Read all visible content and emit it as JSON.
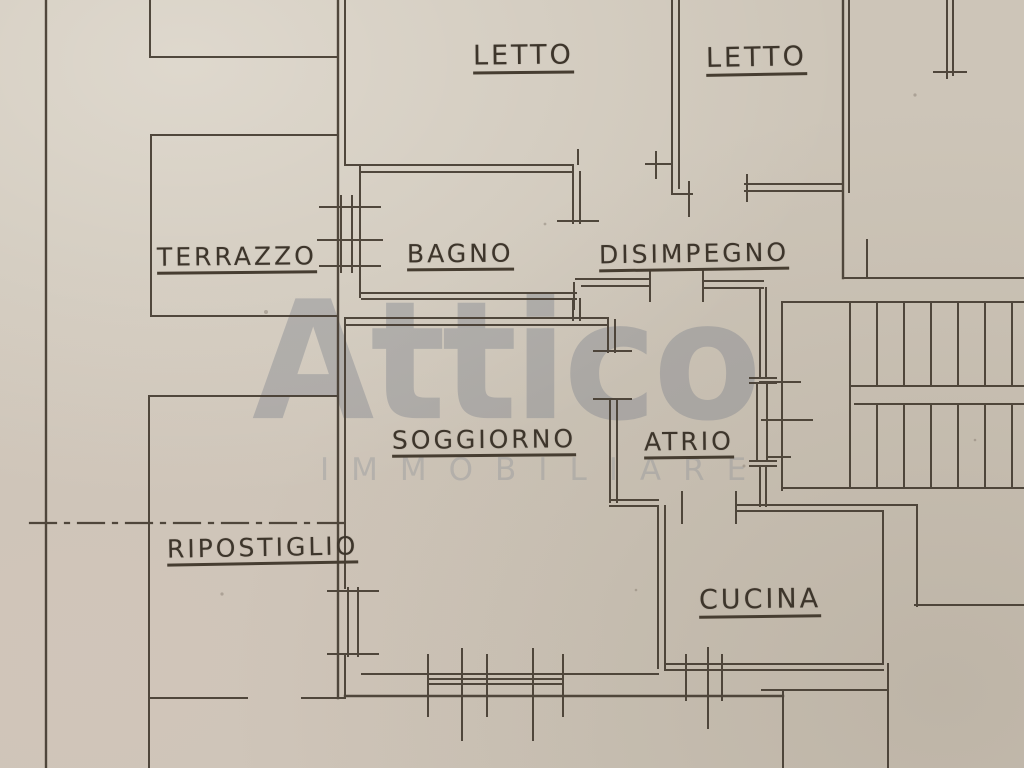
{
  "document": {
    "kind": "hand-drawn apartment floor plan (scanned)",
    "language": "Italian"
  },
  "rooms": [
    {
      "id": "letto-1",
      "label": "LETTO"
    },
    {
      "id": "letto-2",
      "label": "LETTO"
    },
    {
      "id": "terrazzo",
      "label": "TERRAZZO"
    },
    {
      "id": "bagno",
      "label": "BAGNO"
    },
    {
      "id": "disimpegno",
      "label": "DISIMPEGNO"
    },
    {
      "id": "soggiorno",
      "label": "SOGGIORNO"
    },
    {
      "id": "atrio",
      "label": "ATRIO"
    },
    {
      "id": "ripostiglio",
      "label": "RIPOSTIGLIO"
    },
    {
      "id": "cucina",
      "label": "CUCINA"
    }
  ],
  "watermark": {
    "brand": "Attico",
    "subtitle": "IMMOBILIARE"
  },
  "features": {
    "staircase": {
      "flights": 2,
      "treads_per_flight": 6,
      "position": "top-right"
    },
    "axis_line_style": "dash-dot centerline through ripostiglio area"
  },
  "colors": {
    "paper": "#cdc5b8",
    "ink": "#453c31",
    "watermark": "#7c838c"
  }
}
